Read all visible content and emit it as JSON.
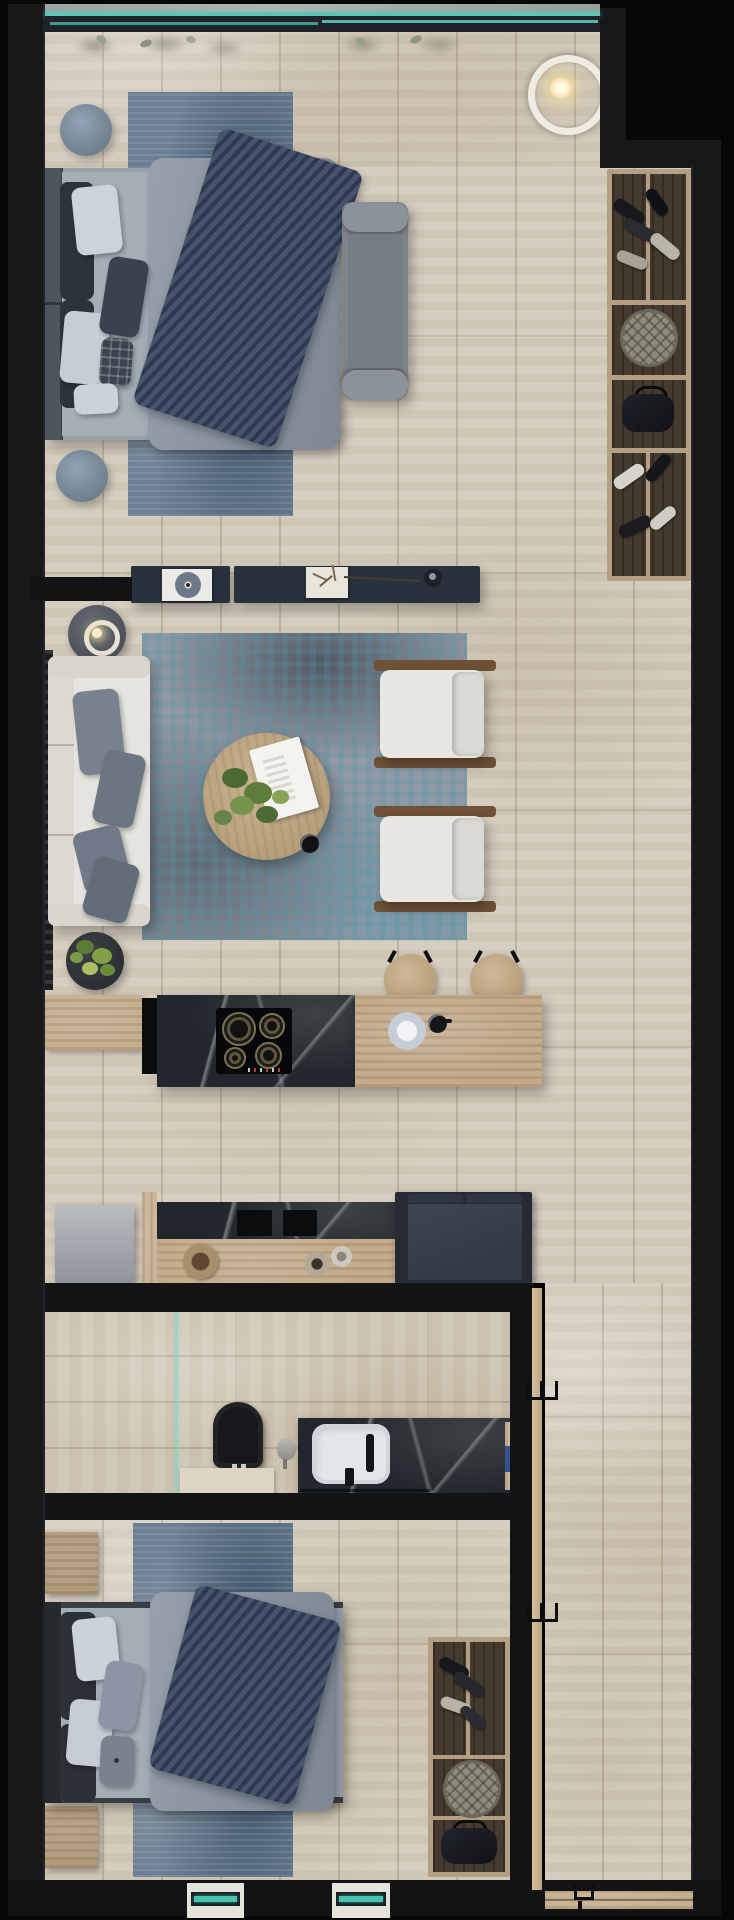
{
  "scene": {
    "title": "apartment-floor-plan-3d-render",
    "view": "top-down",
    "text_visible": "none"
  },
  "palette": {
    "background": "#070708",
    "wall": "#17181a",
    "floor_travertine": "#d4ccbd",
    "floor_bathroom": "#cfc6b4",
    "rug_blue": "#6d8093",
    "rug_living_base": "#939aa6",
    "rug_living_accent": "#4f96a6",
    "sofa_white": "#e6e4de",
    "armchair_white": "#e8e7e2",
    "pillow_gray": "#78818d",
    "throw_navy": "#36425c",
    "wood_light": "#c2aa8a",
    "wood_rail": "#6e5136",
    "marble_dark": "#22272d",
    "console_navy": "#2a313c",
    "appliance_navy": "#38404e",
    "glass_teal": "#52bfb0",
    "candle_glow": "#f4e7bb",
    "toilet_black": "#16171a",
    "basin_white": "#e2e6ea"
  },
  "rooms": [
    {
      "name": "bedroom-main",
      "furniture": [
        "double-bed",
        "headboard",
        "gray-duvet",
        "navy-knit-throw",
        "pillows",
        "foot-bench",
        "blue-runner-rug",
        "round-pouf-top",
        "round-pouf-bottom",
        "ring-pendant-light",
        "window-wall-plants"
      ]
    },
    {
      "name": "walk-in-closet",
      "furniture": [
        "shoe-shelf-top",
        "patterned-hat-box",
        "handbag",
        "shoe-shelf-bottom"
      ]
    },
    {
      "name": "living-room",
      "furniture": [
        "white-sofa",
        "gray-cushions",
        "candle-side-table",
        "media-console",
        "vinyl-record-frame",
        "decor-tray-dried-plants",
        "teal-area-rug",
        "round-coffee-table",
        "magazine",
        "table-plant",
        "coffee-cup",
        "armchair-upper",
        "armchair-lower",
        "floor-plant"
      ]
    },
    {
      "name": "kitchen",
      "furniture": [
        "left-counter",
        "marble-island",
        "four-burner-cooktop",
        "wood-island-top",
        "serving-bowl",
        "espresso-cup",
        "bar-stool-left",
        "bar-stool-right",
        "gray-appliance-box",
        "lower-marble-counter",
        "double-sink-cutouts",
        "wood-tray",
        "ceramic-vases",
        "navy-cabinet-unit"
      ]
    },
    {
      "name": "bathroom",
      "furniture": [
        "glass-partition",
        "wall-hung-black-toilet",
        "low-shelf",
        "paper-holder",
        "black-marble-vanity",
        "white-basin",
        "black-faucet",
        "wood-shelf-with-towel",
        "wooden-door",
        "door-handles"
      ]
    },
    {
      "name": "bedroom-second",
      "furniture": [
        "double-bed",
        "dark-headboard",
        "navy-knit-throw",
        "pillows",
        "nightstand-top",
        "nightstand-bottom",
        "blue-runner-rug",
        "wardrobe-shoes",
        "patterned-hat-box",
        "handbag",
        "wooden-door",
        "door-handles"
      ]
    },
    {
      "name": "hallway",
      "furniture": [
        "travertine-floor",
        "entrance-threshold",
        "entrance-handle",
        "bottom-wall-windows"
      ]
    }
  ]
}
